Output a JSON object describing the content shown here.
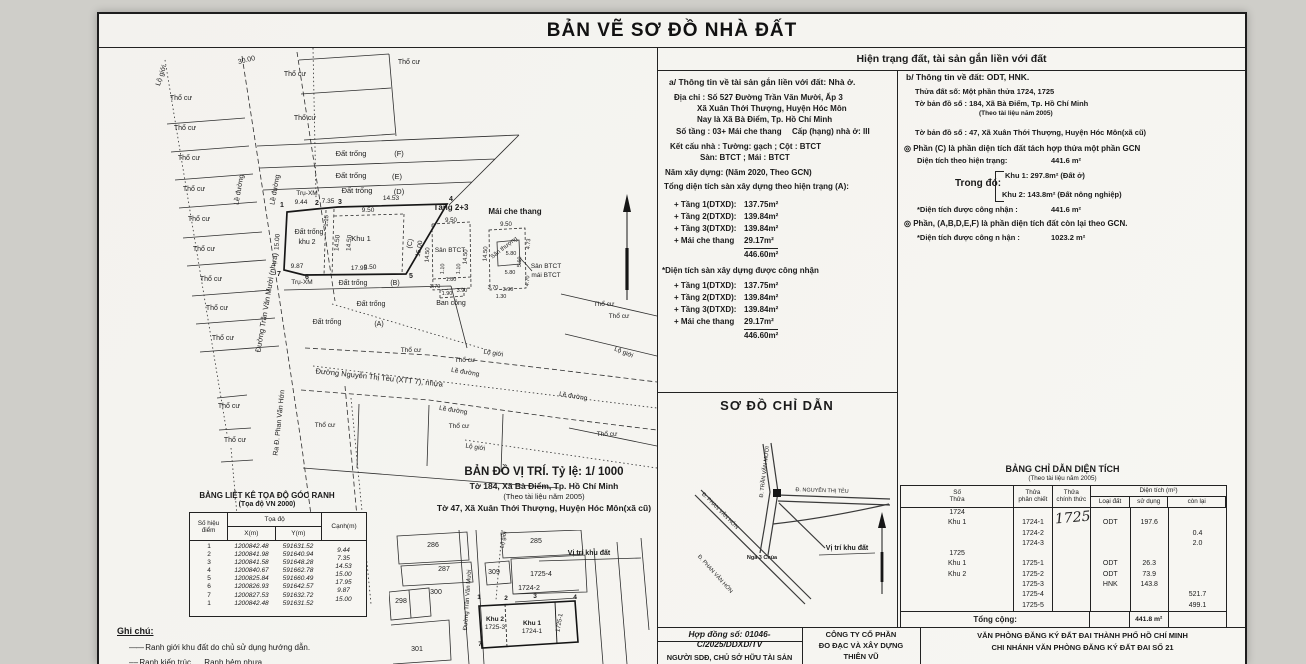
{
  "doc_title": "BẢN VẼ SƠ ĐỒ NHÀ ĐẤT",
  "right_header": "Hiện trạng đất, tài sản gắn liền với đất",
  "panel_a": {
    "heading": "a/ Thông tin về tài sản gắn liền với đất:  Nhà ở.",
    "address1": "Địa chỉ : Số 527 Đường Trần Văn Mười, Ấp 3",
    "address2": "Xã Xuân Thới Thượng, Huyện Hóc Môn",
    "address3": "Nay là Xã Bà Điểm, Tp. Hồ Chí Minh",
    "floors_line": "Số tầng : 03+ Mái che thang",
    "grade_line": "Cấp (hạng) nhà ở: III",
    "structure_line1": "Kết cấu nhà : Tường:   gạch   ; Cột :   BTCT",
    "structure_line2": "Sàn:   BTCT   ; Mái :   BTCT",
    "year_line": "Năm xây dựng:   (Năm 2020, Theo GCN)",
    "current_header": "Tổng diện tích sàn xây dựng theo hiện trạng (A):",
    "current_rows": [
      [
        "+ Tầng 1(DTXD):",
        "137.75m²"
      ],
      [
        "+ Tầng 2(DTXD):",
        "139.84m²"
      ],
      [
        "+ Tầng 3(DTXD):",
        "139.84m²"
      ],
      [
        "+ Mái che thang",
        "29.17m²"
      ]
    ],
    "current_total": "446.60m²",
    "recognized_header": "*Diện tích sàn xây dựng được công nhận",
    "recognized_rows": [
      [
        "+ Tầng 1(DTXD):",
        "137.75m²"
      ],
      [
        "+ Tầng 2(DTXD):",
        "139.84m²"
      ],
      [
        "+ Tầng 3(DTXD):",
        "139.84m²"
      ],
      [
        "+ Mái che thang",
        "29.17m²"
      ]
    ],
    "recognized_total": "446.60m²"
  },
  "panel_b": {
    "heading": "b/ Thông tin về đất:  ODT, HNK.",
    "plot_line": "Thửa đất số:    Một phần thửa 1724, 1725",
    "sheet_line1": "Tờ bản đồ số :   184, Xã Bà Điểm, Tp. Hồ Chí Minh",
    "sheet_note": "(Theo tài liệu năm 2005)",
    "sheet_line2": "Tờ bản đồ số :   47, Xã Xuân Thới Thượng, Huyện Hóc Môn(xã cũ)",
    "part_c_heading": "◎  Phần (C) là phần diện tích đất tách hợp thửa một phần GCN",
    "area_current_label": "Diện tích theo hiện trạng:",
    "area_current_value": "441.6 m²",
    "trong_do": "Trong đó:",
    "khu1": "Khu 1: 297.8m² (Đất ở)",
    "khu2": "Khu 2: 143.8m² (Đất nông nghiệp)",
    "recognized_label": "*Diện tích được công nhận :",
    "recognized_value": "441.6 m²",
    "part_rest_heading": "◎  Phần, (A,B,D,E,F) là phần diện tích đất còn lại theo GCN.",
    "recognized_label2": "*Diện tích được công n hận :",
    "recognized_value2": "1023.2 m²"
  },
  "guide_map": {
    "title": "SƠ ĐỒ CHỈ DẪN",
    "labels": [
      {
        "t": "Đ. TRẦN VĂN MƯỜI",
        "x": 109,
        "y": 80,
        "r": -83,
        "s": 5.5
      },
      {
        "t": "Đ. NGUYỄN THỊ TẺU",
        "x": 165,
        "y": 100,
        "r": 2,
        "s": 5.5
      },
      {
        "t": "Đ. PHAN VĂN HỚN",
        "x": 62,
        "y": 120,
        "r": 45,
        "s": 5.5
      },
      {
        "t": "Đ. PHAN VĂN HỚN",
        "x": 57,
        "y": 183,
        "r": 48,
        "s": 5.5
      },
      {
        "t": "Ngã 3 Chùa",
        "x": 105,
        "y": 167,
        "s": 5.5,
        "b": 1
      },
      {
        "t": "Vị trí khu đất",
        "x": 190,
        "y": 158,
        "s": 7,
        "b": 1
      }
    ]
  },
  "area_table": {
    "title": "BẢNG CHỈ DẪN DIỆN TÍCH",
    "subtitle": "(Theo tài liệu năm 2005)",
    "headers": {
      "so_thua": "Số|Thửa",
      "phan_chiet": "Thửa|phân chiết",
      "chinh_thuc": "Thửa|chính thức",
      "dien_tich": "Diện tích (m²)",
      "loai_dat": "Loại đất",
      "su_dung": "sử dụng",
      "con_lai": "còn lại"
    },
    "handwritten": "1725",
    "rows": [
      [
        "1724",
        "",
        "",
        "",
        "",
        ""
      ],
      [
        "Khu 1",
        "1724-1",
        "",
        "ODT",
        "197.6",
        ""
      ],
      [
        "",
        "1724-2",
        "",
        "",
        "",
        "0.4"
      ],
      [
        "",
        "1724-3",
        "",
        "",
        "",
        "2.0"
      ],
      [
        "1725",
        "",
        "",
        "",
        "",
        ""
      ],
      [
        "Khu 1",
        "1725-1",
        "",
        "ODT",
        "26.3",
        ""
      ],
      [
        "Khu 2",
        "1725-2",
        "",
        "ODT",
        "73.9",
        ""
      ],
      [
        "",
        "1725-3",
        "",
        "HNK",
        "143.8",
        ""
      ],
      [
        "",
        "1725-4",
        "",
        "",
        "",
        "521.7"
      ],
      [
        "",
        "1725-5",
        "",
        "",
        "",
        "499.1"
      ]
    ],
    "total_label": "Tổng cộng:",
    "total_value": "441.8 m²"
  },
  "coord_table": {
    "title": "BẢNG LIỆT KÊ TỌA ĐỘ GÓC RANH",
    "subtitle": "(Tọa độ VN 2000)",
    "headers": {
      "point": "Số hiệu|điểm",
      "toado": "Tọa độ",
      "x": "X(m)",
      "y": "Y(m)",
      "edge": "Cạnh(m)"
    },
    "rows": [
      [
        "1",
        "1200842.48",
        "591631.52",
        "9.44"
      ],
      [
        "2",
        "1200841.98",
        "591640.94",
        "7.35"
      ],
      [
        "3",
        "1200841.58",
        "591648.28",
        "14.53"
      ],
      [
        "4",
        "1200840.67",
        "591662.78",
        "15.00"
      ],
      [
        "5",
        "1200825.84",
        "591660.49",
        "17.95"
      ],
      [
        "6",
        "1200826.93",
        "591642.57",
        "9.87"
      ],
      [
        "7",
        "1200827.53",
        "591632.72",
        "15.00"
      ],
      [
        "1",
        "1200842.48",
        "591631.52",
        ""
      ]
    ]
  },
  "legend": {
    "title": "Ghi chú:",
    "line1": "Ranh giới khu đất do chủ sử dụng hướng dẫn.",
    "line2a": "Ranh kiến trúc",
    "line2b": "Ranh hẻm nhựa"
  },
  "location_map": {
    "title": "BẢN ĐỒ VỊ TRÍ. Tỷ lệ: 1/ 1000",
    "line1": "Tờ 184, Xã Bà Điểm, Tp. Hồ Chí Minh",
    "line2": "(Theo tài liệu năm 2005)",
    "line3": "Tờ 47, Xã Xuân Thới Thượng, Huyện Hóc Môn(xã cũ)",
    "labels": [
      {
        "t": "286",
        "x": 44,
        "y": 17,
        "s": 7
      },
      {
        "t": "285",
        "x": 147,
        "y": 13,
        "s": 7
      },
      {
        "t": "287",
        "x": 55,
        "y": 41,
        "s": 7
      },
      {
        "t": "309",
        "x": 105,
        "y": 44,
        "s": 7
      },
      {
        "t": "1725-4",
        "x": 152,
        "y": 46,
        "s": 7
      },
      {
        "t": "Vị trí khu đất",
        "x": 200,
        "y": 25,
        "s": 7,
        "b": 1
      },
      {
        "t": "298",
        "x": 12,
        "y": 73,
        "s": 7
      },
      {
        "t": "300",
        "x": 47,
        "y": 64,
        "s": 7
      },
      {
        "t": "1724-2",
        "x": 140,
        "y": 60,
        "s": 7
      },
      {
        "t": "Khu 2",
        "x": 106,
        "y": 91,
        "s": 6.5,
        "b": 1
      },
      {
        "t": "1725-3",
        "x": 106,
        "y": 99,
        "s": 6.5
      },
      {
        "t": "Khu 1",
        "x": 143,
        "y": 95,
        "s": 6.5,
        "b": 1
      },
      {
        "t": "1724-1",
        "x": 143,
        "y": 103,
        "s": 6.5
      },
      {
        "t": "1725-1",
        "x": 172,
        "y": 93,
        "r": -80,
        "s": 6
      },
      {
        "t": "301",
        "x": 28,
        "y": 121,
        "s": 7
      },
      {
        "t": "7",
        "x": 91,
        "y": 116,
        "s": 6.5,
        "b": 1
      },
      {
        "t": "1",
        "x": 90,
        "y": 69,
        "s": 6.5,
        "b": 1
      },
      {
        "t": "2",
        "x": 117,
        "y": 70,
        "s": 6.5,
        "b": 1
      },
      {
        "t": "3",
        "x": 146,
        "y": 68,
        "s": 6.5,
        "b": 1
      },
      {
        "t": "4",
        "x": 186,
        "y": 69,
        "s": 6.5,
        "b": 1
      },
      {
        "t": "Đường Trần Văn Mười",
        "x": 80,
        "y": 70,
        "r": -86,
        "s": 6
      },
      {
        "t": "Lộ giới",
        "x": 116,
        "y": 10,
        "r": -80,
        "s": 5.5
      }
    ]
  },
  "site_plan": {
    "labels": [
      {
        "t": "Lộ giới",
        "x": 64,
        "y": 28,
        "r": -72,
        "s": 7
      },
      {
        "t": "30.00",
        "x": 148,
        "y": 14,
        "r": -14,
        "s": 7
      },
      {
        "t": "Lề đường",
        "x": 142,
        "y": 142,
        "r": -80,
        "s": 7
      },
      {
        "t": "Lề đường",
        "x": 178,
        "y": 142,
        "r": -80,
        "s": 7
      },
      {
        "t": "Đường Trần Văn Mười (nhựa)",
        "x": 170,
        "y": 255,
        "r": -80,
        "s": 7.5
      },
      {
        "t": "Ra Đ. Phan Văn Hớn",
        "x": 182,
        "y": 375,
        "r": -84,
        "s": 7
      },
      {
        "t": "Thổ cư",
        "x": 82,
        "y": 52,
        "s": 7
      },
      {
        "t": "Thổ cư",
        "x": 86,
        "y": 82,
        "s": 7
      },
      {
        "t": "Thổ cư",
        "x": 90,
        "y": 112,
        "s": 7
      },
      {
        "t": "Thổ cư",
        "x": 95,
        "y": 143,
        "s": 7
      },
      {
        "t": "Thổ cư",
        "x": 100,
        "y": 173,
        "s": 7
      },
      {
        "t": "Thổ cư",
        "x": 105,
        "y": 203,
        "s": 7
      },
      {
        "t": "Thổ cư",
        "x": 112,
        "y": 233,
        "s": 7
      },
      {
        "t": "Thổ cư",
        "x": 118,
        "y": 262,
        "s": 7
      },
      {
        "t": "Thổ cư",
        "x": 124,
        "y": 292,
        "s": 7
      },
      {
        "t": "Thổ cư",
        "x": 130,
        "y": 360,
        "s": 7
      },
      {
        "t": "Thổ cư",
        "x": 136,
        "y": 394,
        "s": 7
      },
      {
        "t": "Thổ cư",
        "x": 196,
        "y": 28,
        "s": 7
      },
      {
        "t": "Thổ cư",
        "x": 206,
        "y": 72,
        "s": 7
      },
      {
        "t": "Thổ cư",
        "x": 310,
        "y": 16,
        "s": 7
      },
      {
        "t": "Đất trống",
        "x": 252,
        "y": 108,
        "s": 7.5
      },
      {
        "t": "(F)",
        "x": 300,
        "y": 108,
        "s": 7.5
      },
      {
        "t": "Đất trống",
        "x": 252,
        "y": 130,
        "s": 7.5
      },
      {
        "t": "(E)",
        "x": 298,
        "y": 131,
        "s": 7.5
      },
      {
        "t": "Trụ-XM",
        "x": 208,
        "y": 147,
        "s": 6.5
      },
      {
        "t": "Đất trống",
        "x": 258,
        "y": 145,
        "s": 7.5
      },
      {
        "t": "(D)",
        "x": 300,
        "y": 146,
        "s": 7.5
      },
      {
        "t": "9.44",
        "x": 202,
        "y": 156,
        "s": 6.5
      },
      {
        "t": "2",
        "x": 218,
        "y": 157,
        "s": 7,
        "b": 1
      },
      {
        "t": "7.35",
        "x": 229,
        "y": 155,
        "s": 6.5
      },
      {
        "t": "3",
        "x": 241,
        "y": 156,
        "s": 7,
        "b": 1
      },
      {
        "t": "14.53",
        "x": 292,
        "y": 152,
        "s": 6.5
      },
      {
        "t": "1",
        "x": 183,
        "y": 159,
        "s": 7,
        "b": 1
      },
      {
        "t": "4",
        "x": 352,
        "y": 153,
        "s": 7,
        "b": 1
      },
      {
        "t": "15.00",
        "x": 180,
        "y": 194,
        "r": -86,
        "s": 6.5
      },
      {
        "t": "Đất trống",
        "x": 210,
        "y": 186,
        "s": 7
      },
      {
        "t": "khu 2",
        "x": 208,
        "y": 196,
        "s": 7
      },
      {
        "t": "1.15",
        "x": 229,
        "y": 173,
        "r": -86,
        "s": 6
      },
      {
        "t": "14.50",
        "x": 240,
        "y": 195,
        "r": -86,
        "s": 6.5
      },
      {
        "t": "14.50",
        "x": 252,
        "y": 195,
        "r": -86,
        "s": 6.5
      },
      {
        "t": "9.50",
        "x": 269,
        "y": 164,
        "s": 6.5
      },
      {
        "t": "Khu 1",
        "x": 262,
        "y": 193,
        "s": 7.5
      },
      {
        "t": "9.50",
        "x": 271,
        "y": 221,
        "s": 6.5
      },
      {
        "t": "(C)",
        "x": 313,
        "y": 196,
        "r": -80,
        "s": 7
      },
      {
        "t": "15.00",
        "x": 322,
        "y": 201,
        "r": -80,
        "s": 6.5
      },
      {
        "t": "7",
        "x": 180,
        "y": 228,
        "s": 7,
        "b": 1
      },
      {
        "t": "9.87",
        "x": 198,
        "y": 220,
        "s": 6.5
      },
      {
        "t": "6",
        "x": 208,
        "y": 231,
        "s": 7,
        "b": 1
      },
      {
        "t": "17.95",
        "x": 260,
        "y": 222,
        "s": 6.5
      },
      {
        "t": "5",
        "x": 312,
        "y": 230,
        "s": 7,
        "b": 1
      },
      {
        "t": "Trụ-XM",
        "x": 203,
        "y": 236,
        "s": 6.5
      },
      {
        "t": "Đất trống",
        "x": 254,
        "y": 237,
        "s": 7
      },
      {
        "t": "(B)",
        "x": 296,
        "y": 237,
        "s": 7
      },
      {
        "t": "Đất trống",
        "x": 272,
        "y": 258,
        "s": 7
      },
      {
        "t": "Đất trống",
        "x": 228,
        "y": 276,
        "s": 7
      },
      {
        "t": "(A)",
        "x": 280,
        "y": 278,
        "s": 7
      },
      {
        "t": "Tầng 2+3",
        "x": 352,
        "y": 162,
        "s": 8,
        "b": 1
      },
      {
        "t": "Mái che thang",
        "x": 416,
        "y": 166,
        "s": 8,
        "b": 1
      },
      {
        "t": "9.50",
        "x": 352,
        "y": 174,
        "s": 6
      },
      {
        "t": "14.50",
        "x": 330,
        "y": 207,
        "r": -86,
        "s": 6
      },
      {
        "t": "14.50",
        "x": 368,
        "y": 209,
        "r": -86,
        "s": 6
      },
      {
        "t": "Sân BTCT",
        "x": 351,
        "y": 204,
        "s": 6.5
      },
      {
        "t": "1.10",
        "x": 345,
        "y": 221,
        "r": -86,
        "s": 5.5
      },
      {
        "t": "1.10",
        "x": 361,
        "y": 221,
        "r": -86,
        "s": 5.5
      },
      {
        "t": "1.80",
        "x": 352,
        "y": 233,
        "s": 5.5
      },
      {
        "t": "3.70",
        "x": 336,
        "y": 240,
        "s": 5.5
      },
      {
        "t": "1.90",
        "x": 348,
        "y": 247,
        "s": 5.5
      },
      {
        "t": "3.90",
        "x": 363,
        "y": 244,
        "s": 5.5
      },
      {
        "t": "Ban công",
        "x": 352,
        "y": 257,
        "s": 7
      },
      {
        "t": "9.50",
        "x": 407,
        "y": 178,
        "s": 6
      },
      {
        "t": "14.50",
        "x": 388,
        "y": 206,
        "r": -86,
        "s": 6
      },
      {
        "t": "Sân thượng",
        "x": 406,
        "y": 201,
        "r": -38,
        "s": 6
      },
      {
        "t": "5.80",
        "x": 412,
        "y": 207,
        "s": 5.5
      },
      {
        "t": "5.80",
        "x": 411,
        "y": 226,
        "s": 5.5
      },
      {
        "t": "5.60",
        "x": 422,
        "y": 214,
        "r": -86,
        "s": 5.5
      },
      {
        "t": "4.73",
        "x": 431,
        "y": 196,
        "r": -86,
        "s": 5.5
      },
      {
        "t": "4.70",
        "x": 430,
        "y": 233,
        "r": -86,
        "s": 5.5
      },
      {
        "t": "3.70",
        "x": 394,
        "y": 241,
        "s": 5.5
      },
      {
        "t": "3.90",
        "x": 409,
        "y": 243,
        "s": 5.5
      },
      {
        "t": "1.30",
        "x": 402,
        "y": 250,
        "s": 5.5
      },
      {
        "t": "Sân BTCT",
        "x": 447,
        "y": 220,
        "s": 6.5
      },
      {
        "t": "mái BTCT",
        "x": 447,
        "y": 229,
        "s": 6.5
      },
      {
        "t": "Thổ cư",
        "x": 312,
        "y": 304,
        "s": 6.5
      },
      {
        "t": "Thổ cư",
        "x": 366,
        "y": 314,
        "s": 6.5
      },
      {
        "t": "Lộ giới",
        "x": 394,
        "y": 307,
        "r": 9,
        "s": 6.5
      },
      {
        "t": "Đường Nguyễn Thị Tẻu (XTT 7), nhựa",
        "x": 280,
        "y": 332,
        "r": 6,
        "s": 7.5
      },
      {
        "t": "Lề đường",
        "x": 366,
        "y": 326,
        "r": 9,
        "s": 6.5
      },
      {
        "t": "Lề đường",
        "x": 354,
        "y": 364,
        "r": 9,
        "s": 6.5
      },
      {
        "t": "Lề đường",
        "x": 474,
        "y": 350,
        "r": 9,
        "s": 6.5
      },
      {
        "t": "Lộ giới",
        "x": 376,
        "y": 401,
        "r": 9,
        "s": 6.5
      },
      {
        "t": "Lộ giới",
        "x": 524,
        "y": 306,
        "r": 22,
        "s": 6.5
      },
      {
        "t": "Thổ cư",
        "x": 505,
        "y": 258,
        "s": 6.5
      },
      {
        "t": "Thổ cư",
        "x": 520,
        "y": 270,
        "s": 6.5
      },
      {
        "t": "Thổ cư",
        "x": 226,
        "y": 379,
        "s": 6.5
      },
      {
        "t": "Thổ cư",
        "x": 360,
        "y": 380,
        "s": 6.5
      },
      {
        "t": "Thổ cư",
        "x": 508,
        "y": 388,
        "s": 6.5
      }
    ]
  },
  "footer": {
    "contract": "Hợp đồng số: 01046-C/2025/DDXD/TV",
    "owner": "NGƯỜI SDĐ, CHỦ SỞ HỮU TÀI SẢN",
    "owner_sub": "(Ký, ghi rõ họ tên)",
    "company1": "CÔNG TY CỔ PHẦN",
    "company2": "ĐO ĐẠC VÀ XÂY DỰNG",
    "company3": "THIÊN VŨ",
    "office1": "VĂN PHÒNG ĐĂNG KÝ ĐẤT ĐAI THÀNH PHỐ HỒ CHÍ MINH",
    "office2": "CHI NHÁNH VĂN PHÒNG ĐĂNG KÝ ĐẤT ĐAI SỐ 21"
  }
}
